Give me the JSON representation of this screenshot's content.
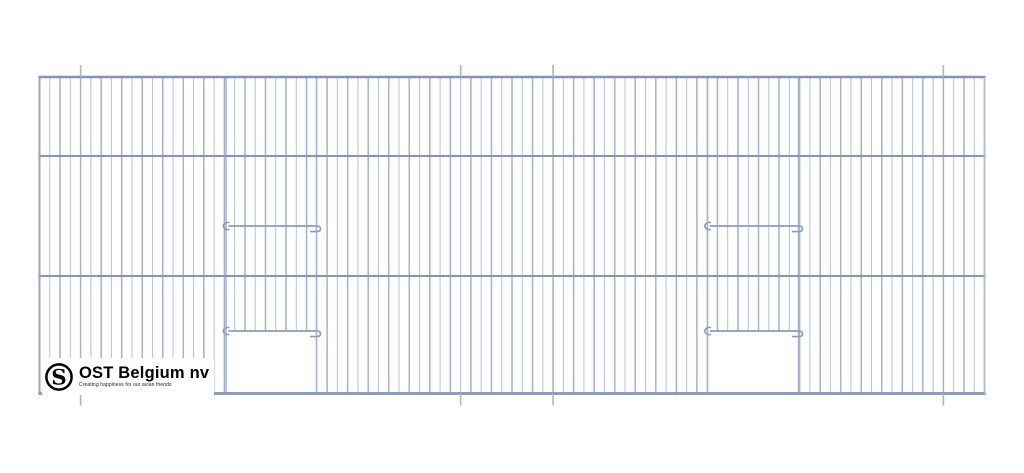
{
  "drawing": {
    "description": "Cage front panel technical drawing with two vertical sliding doors",
    "panel": {
      "left": 39.5,
      "right": 984.5,
      "top": 77,
      "bottom": 393.5,
      "bar_ys": [
        77,
        156,
        276,
        393.5
      ],
      "wire_count": 93,
      "hanger_wire_indices": [
        4,
        41,
        50,
        88
      ],
      "tick_length": 12,
      "doors": [
        {
          "rail_x1": 221.5,
          "rail_x2": 320,
          "top_rail_y": 226,
          "bottom_rail_y": 331,
          "open_x1": 226,
          "open_x2": 316.5
        },
        {
          "rail_x1": 703,
          "rail_x2": 802,
          "top_rail_y": 226,
          "bottom_rail_y": 331,
          "open_x1": 707.5,
          "open_x2": 798.5
        }
      ],
      "colors": {
        "bar": "#8495b5",
        "wire_a": "#a6b2cb",
        "wire_b": "#bdc6d8",
        "rail": "#8b9cba",
        "tick": "#a9b5cc",
        "border_left": "#98a6c1",
        "border_right": "#b0bccf"
      }
    },
    "logo": {
      "title": "OST Belgium nv",
      "tagline": "Creating happiness for our avian friends",
      "emblem_letter": "S",
      "color": "#000000"
    }
  }
}
